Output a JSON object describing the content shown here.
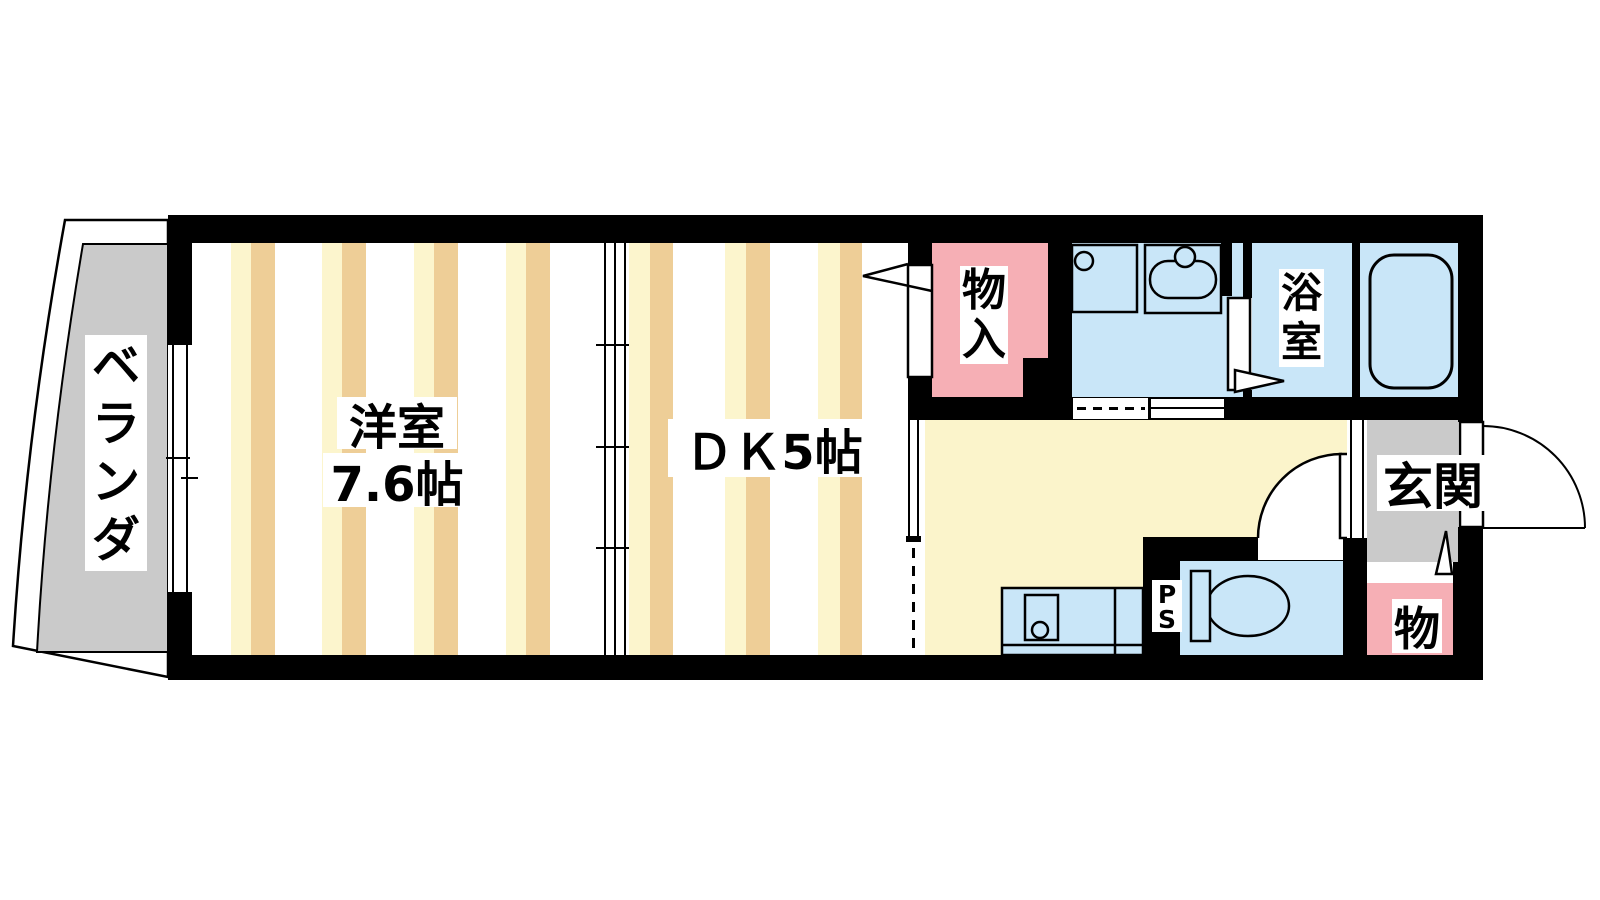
{
  "rooms": {
    "balcony": {
      "label": "ベランダ"
    },
    "western_room": {
      "label": "洋室",
      "size": "7.6帖"
    },
    "dining_kitchen": {
      "label": "ＤＫ5帖"
    },
    "closet": {
      "label": "物入"
    },
    "bathroom": {
      "label": "浴室"
    },
    "entrance": {
      "label": "玄関"
    },
    "small_storage": {
      "label": "物"
    },
    "pipe_space": {
      "label": "PS"
    }
  },
  "colors": {
    "stripe_light": "#FCF5CD",
    "stripe_dark": "#EECE97",
    "hallway": "#FBF4CB",
    "water_blue": "#C9E6F8",
    "closet_pink": "#F6AFB5",
    "balcony_gray": "#CACACA",
    "wall": "#000000"
  }
}
